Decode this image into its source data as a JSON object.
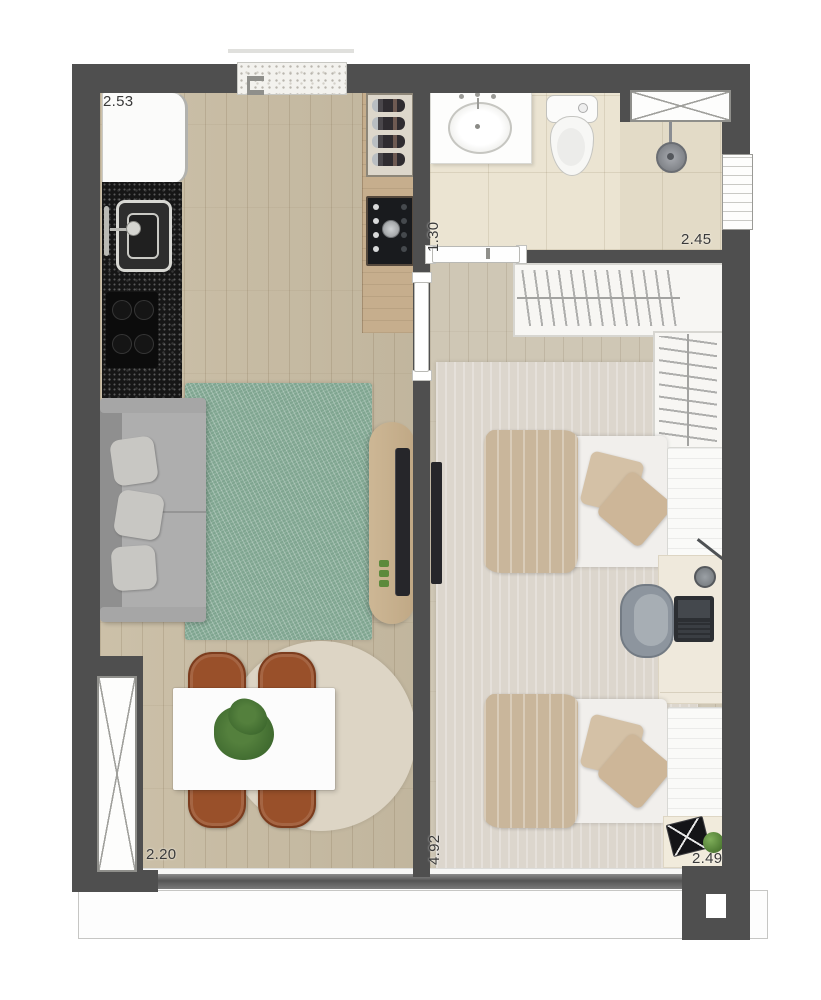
{
  "plan": {
    "dimensions": {
      "kitchen": "2.53",
      "bath_corridor": "1.30",
      "bathroom": "2.45",
      "living": "2.20",
      "bedroom_length": "4.92",
      "bedroom_width": "2.49"
    },
    "colors": {
      "wall": "#4f4f4f",
      "wood_floor": "#c9bda4",
      "bedroom_floor": "#cfc7b5",
      "bathroom_tile": "#ebe4d2",
      "rug_green": "#7fa590",
      "rug_round": "#ddd5c5",
      "rug_bedroom": "#dcd6cd",
      "chair_leather": "#99502a",
      "counter_granite": "#161616",
      "sofa_gray": "#a3a3a3",
      "bed_blanket": "#c9b69b",
      "tv_black": "#26262a",
      "wood_cabinet": "#c6ae8d"
    }
  }
}
